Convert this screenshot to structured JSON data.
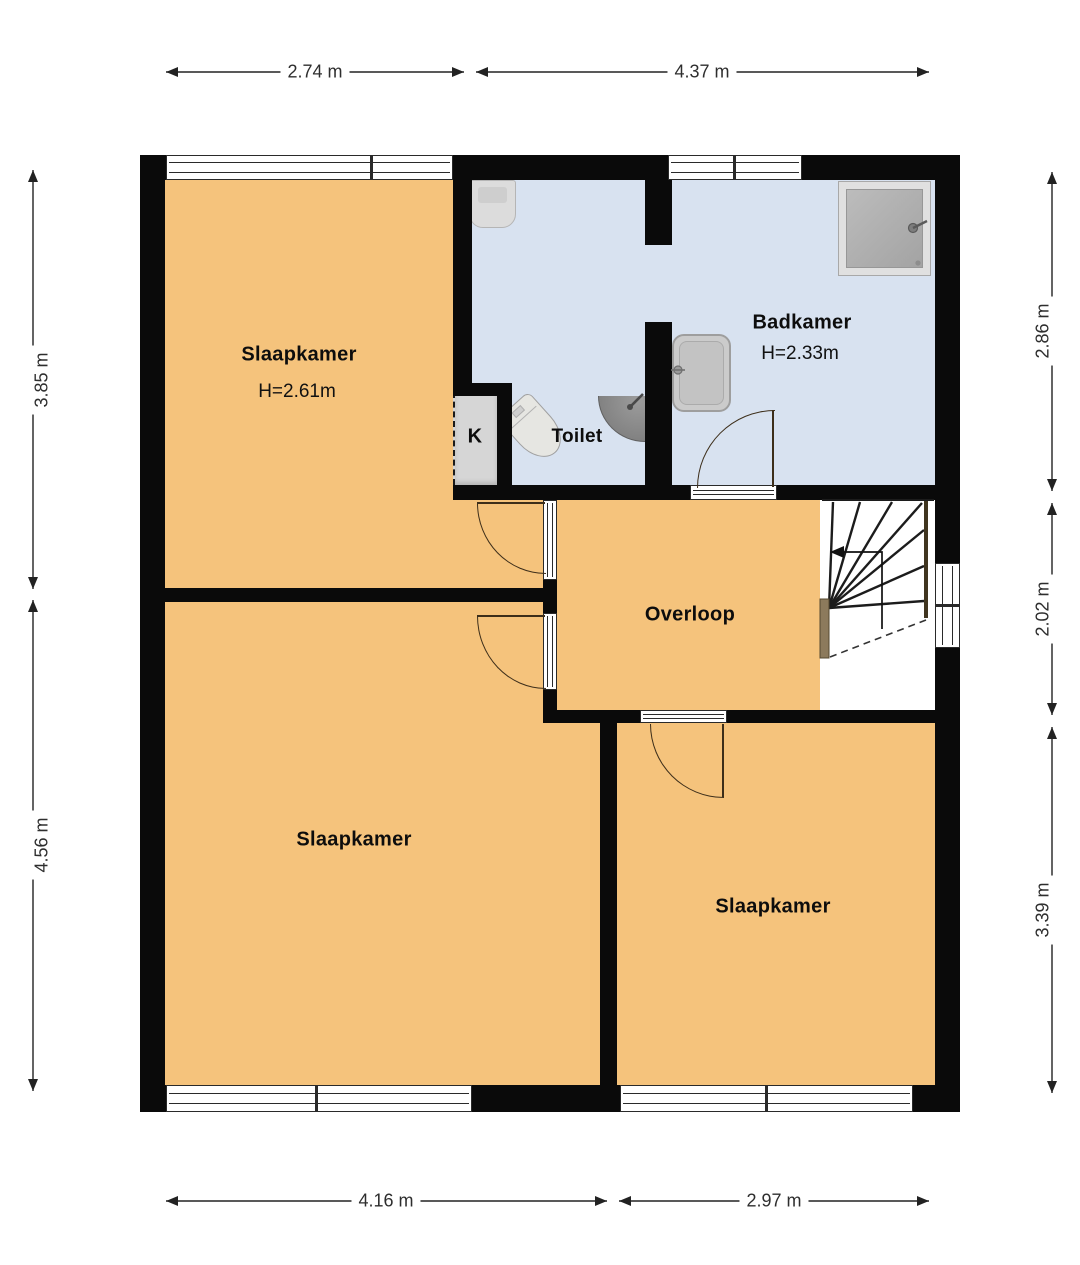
{
  "plan": {
    "type": "floor-plan",
    "floor": "verdieping (bedroom floor)",
    "colors": {
      "wall": "#0a0a0a",
      "room_fill": "#f5c37c",
      "bathroom_fill": "#d8e2f0",
      "closet_fill": "#d6d6d6",
      "fixture_fill": "#d9d9d9",
      "stair_rail_accent": "#8c7a5c",
      "dimension_text": "#2e2e2e"
    }
  },
  "rooms": {
    "slaapkamer_top": {
      "label": "Slaapkamer",
      "ceiling_height": "H=2.61m"
    },
    "badkamer": {
      "label": "Badkamer",
      "ceiling_height": "H=2.33m"
    },
    "toilet": {
      "label": "Toilet"
    },
    "kast": {
      "label": "K"
    },
    "overloop": {
      "label": "Overloop"
    },
    "slaapkamer_bottom_left": {
      "label": "Slaapkamer"
    },
    "slaapkamer_bottom_right": {
      "label": "Slaapkamer"
    }
  },
  "dimensions": {
    "top": [
      "2.74 m",
      "4.37 m"
    ],
    "bottom": [
      "4.16 m",
      "2.97 m"
    ],
    "left": [
      "3.85 m",
      "4.56 m"
    ],
    "right": [
      "2.86 m",
      "2.02 m",
      "3.39 m"
    ]
  },
  "fixtures": [
    "shower-tray",
    "washbasin",
    "wastafel-sink",
    "toilet-bowl",
    "corner-sink",
    "staircase",
    "stair-direction-arrow",
    "closet"
  ]
}
